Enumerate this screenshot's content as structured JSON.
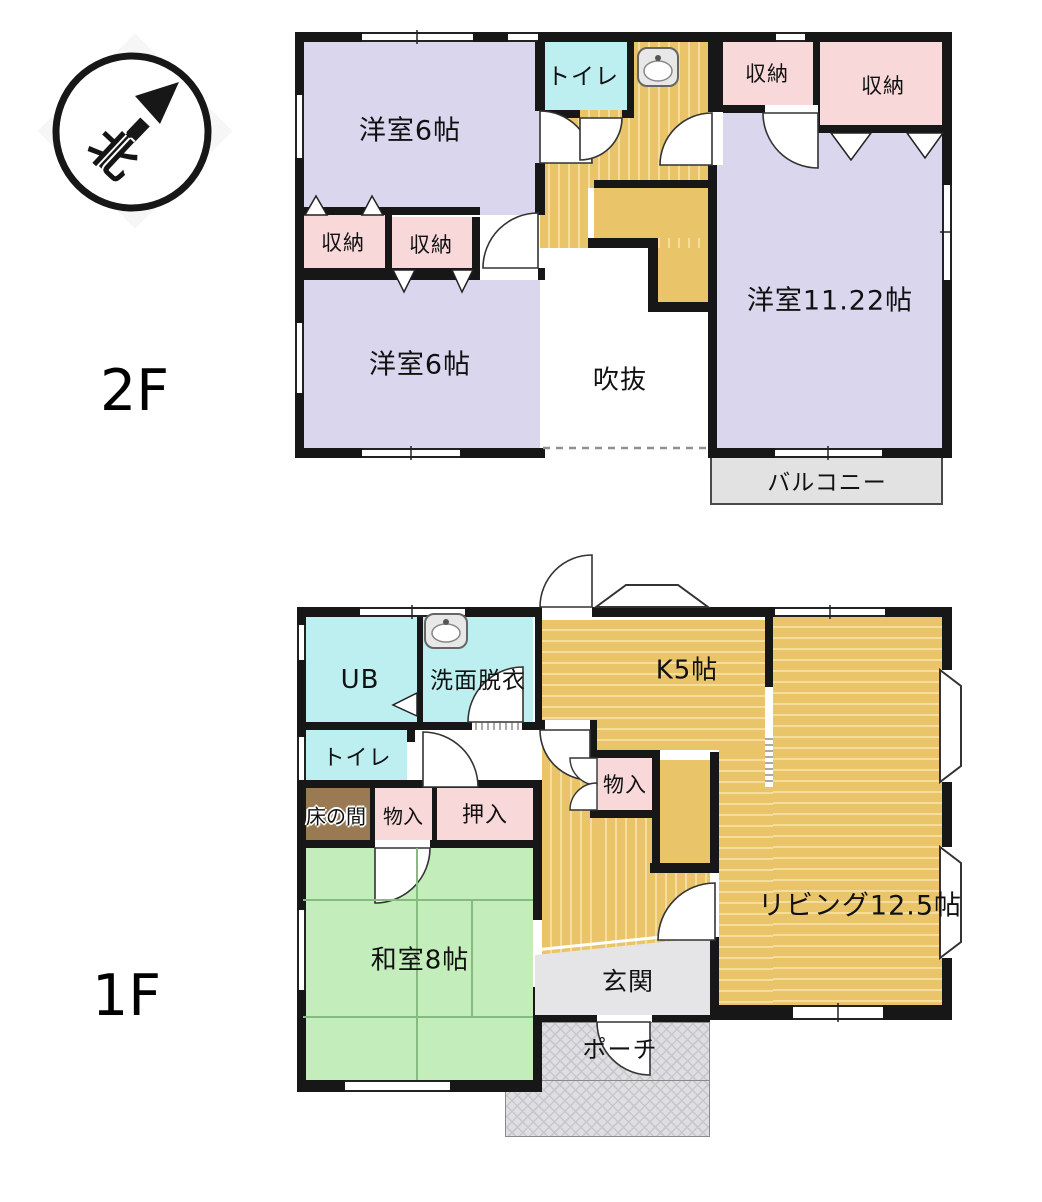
{
  "compass": {
    "north": "北"
  },
  "floors": {
    "f2": {
      "label": "2F",
      "rooms": {
        "western_top": "洋室6帖",
        "toilet": "トイレ",
        "closet_a": "収納",
        "closet_b": "収納",
        "closet_c": "収納",
        "closet_d": "収納",
        "western_large": "洋室11.22帖",
        "western_bottom": "洋室6帖",
        "void": "吹抜",
        "balcony": "バルコニー"
      }
    },
    "f1": {
      "label": "1F",
      "rooms": {
        "ub": "UB",
        "washroom": "洗面脱衣",
        "kitchen": "K5帖",
        "toilet": "トイレ",
        "tokonoma": "床の間",
        "closet_left": "物入",
        "oshiire": "押入",
        "closet_mid": "物入",
        "washitsu": "和室8帖",
        "living": "リビング12.5帖",
        "genkan": "玄関",
        "porch": "ポーチ"
      }
    }
  },
  "colors": {
    "wall": "#171717",
    "western_room": "#d9d6ee",
    "closet": "#f8d8d9",
    "wet_area": "#bdeff1",
    "flooring": "#e9c468",
    "tatami": "#c3eebb",
    "tokonoma": "#9a7a52",
    "balcony": "#e2e2e2",
    "genkan": "#e5e5e7"
  }
}
